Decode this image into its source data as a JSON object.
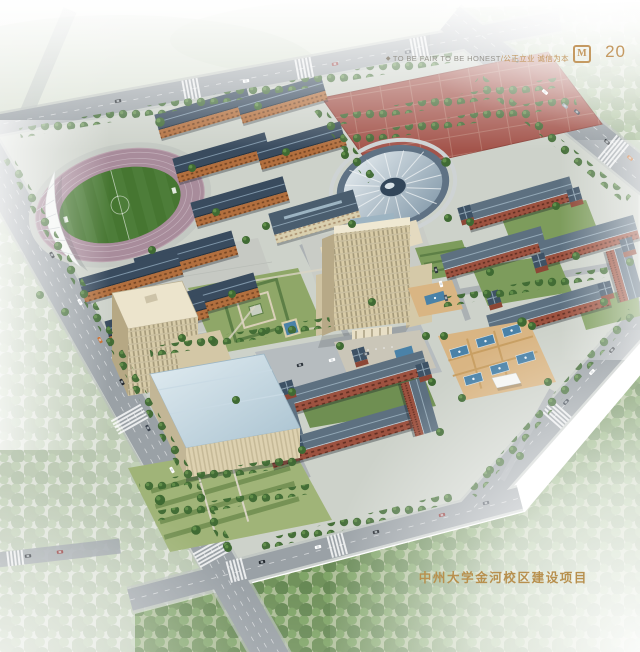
{
  "header": {
    "bullet": "◆",
    "slogan_en": "TO BE FAIR TO BE HONEST",
    "slogan_sep": "/",
    "slogan_zh": "公正立业 诚信为本",
    "logo_glyph": "M",
    "page_number": "20"
  },
  "footer": {
    "project_title": "中州大学金河校区建设项目"
  },
  "palette": {
    "gold_text": "#c59a62",
    "slogan_gray": "#98968f",
    "title_gold": "#b8904e",
    "running_track": "#a88c9b",
    "soccer_field": "#467631",
    "dorm_wall": "#b26f3e",
    "dorm_roof": "#394b5e",
    "brick_wall": "#9d5240",
    "slate_roof": "#5d7080",
    "beige_facade": "#d8cba6",
    "sports_courts": "#a3544b",
    "road_gray": "#9aa1a6",
    "water_blue": "#4a82a8",
    "lawn_green": "#8fa768",
    "tree_green": "#3f6a33"
  },
  "scene": {
    "features": [
      "stadium with running track",
      "grandstand canopy",
      "dormitory blocks",
      "outdoor sports courts",
      "domed gymnasium",
      "dining hall",
      "high-rise main building",
      "brick academic quadrangles",
      "office complex",
      "fountain plaza",
      "central garden",
      "perimeter roads with traffic",
      "surrounding haze"
    ]
  }
}
